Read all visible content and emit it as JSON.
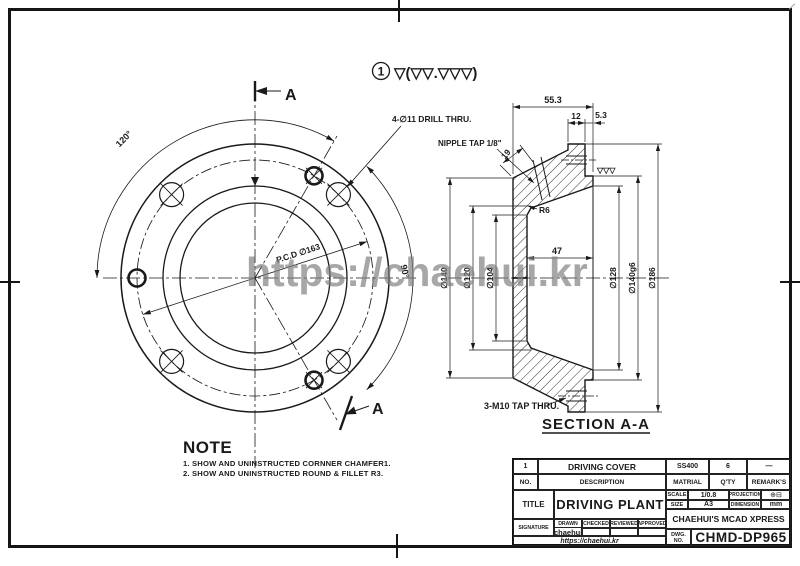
{
  "watermark": "https://chaehui.kr",
  "surface_note": {
    "number": "1",
    "symbols": "▽(▽▽.▽▽▽)"
  },
  "front_view": {
    "section_label": "A",
    "angle_m10_holes": "120°",
    "angle_d11_holes": "90°",
    "drill_callout": "4-∅11 DRILL THRU.",
    "pcd_dim": "P.C.D ∅163"
  },
  "section_view": {
    "caption": "SECTION A-A",
    "nipple_callout": "NIPPLE TAP 1/8\"",
    "tap_callout": "3-M10 TAP THRU.",
    "surface_mark": "▽▽▽",
    "dims": {
      "total_width": "55.3",
      "flange_width": "12",
      "hub_width": "5.3",
      "nipple_depth": "19",
      "fillet": "R6",
      "bore_depth": "47",
      "dia_140": "∅140",
      "dia_120": "∅120",
      "dia_104": "∅104",
      "dia_128": "∅128",
      "dia_140g6": "∅140g6",
      "dia_186": "∅186"
    }
  },
  "note": {
    "heading": "NOTE",
    "line_1": "1. SHOW AND UNINSTRUCTED CORNNER CHAMFER1.",
    "line_2": "2. SHOW AND UNINSTRUCTED ROUND & FILLET R3."
  },
  "title_block": {
    "item": {
      "no": "1",
      "description": "DRIVING COVER",
      "material": "SS400",
      "qty": "6",
      "remark": "—"
    },
    "headers": {
      "no": "NO.",
      "description": "DESCRIPTION",
      "material": "MATRIAL",
      "qty": "Q'TY",
      "remark": "REMARK'S"
    },
    "title_label": "TITLE",
    "title": "DRIVING PLANT",
    "scale_label": "SCALE",
    "scale": "1/0.8",
    "projection_label": "PROJECTION",
    "projection_symbol": "⊕⊟",
    "size_label": "SIZE",
    "size": "A3",
    "dimension_label": "DIMENSION",
    "dimension_unit": "mm",
    "sign_headers": {
      "drawn": "DRAWN",
      "checked": "CHECKED",
      "reviewed": "REVIEWED",
      "approved": "APPROVED"
    },
    "signature_label": "SIGNATURE",
    "signature": "chaehui",
    "url": "https://chaehui.kr",
    "company": "CHAEHUI'S MCAD XPRESS",
    "dwg_label_1": "DWG.",
    "dwg_label_2": "NO.",
    "dwg_no": "CHMD-DP965"
  }
}
